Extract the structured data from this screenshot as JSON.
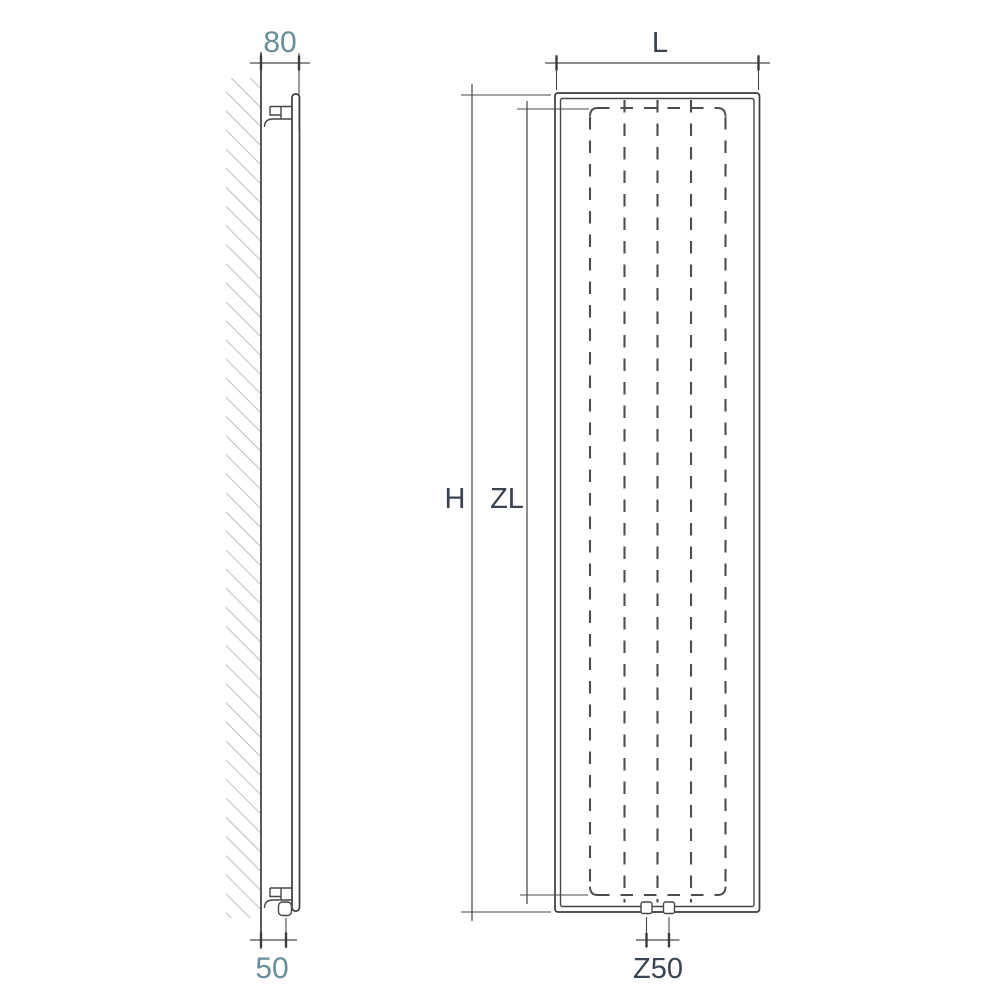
{
  "drawing": {
    "description": "Vertical radiator dimensional drawing, side view and front view",
    "side_view": {
      "wall_to_front_top_label": "80",
      "wall_to_connection_bottom_label": "50"
    },
    "front_view": {
      "width_label": "L",
      "overall_height_label": "H",
      "element_height_label": "ZL",
      "connection_spacing_label": "Z50"
    }
  },
  "colors": {
    "background": "#ffffff",
    "drawing_line": "#3c3c3c",
    "dashed_element_line": "#4d4d4d",
    "dimension_line": "#4a4a4a",
    "hatch": "#9c9c9c",
    "label_numeric": "#688d9b",
    "label_letter": "#3a4350"
  }
}
